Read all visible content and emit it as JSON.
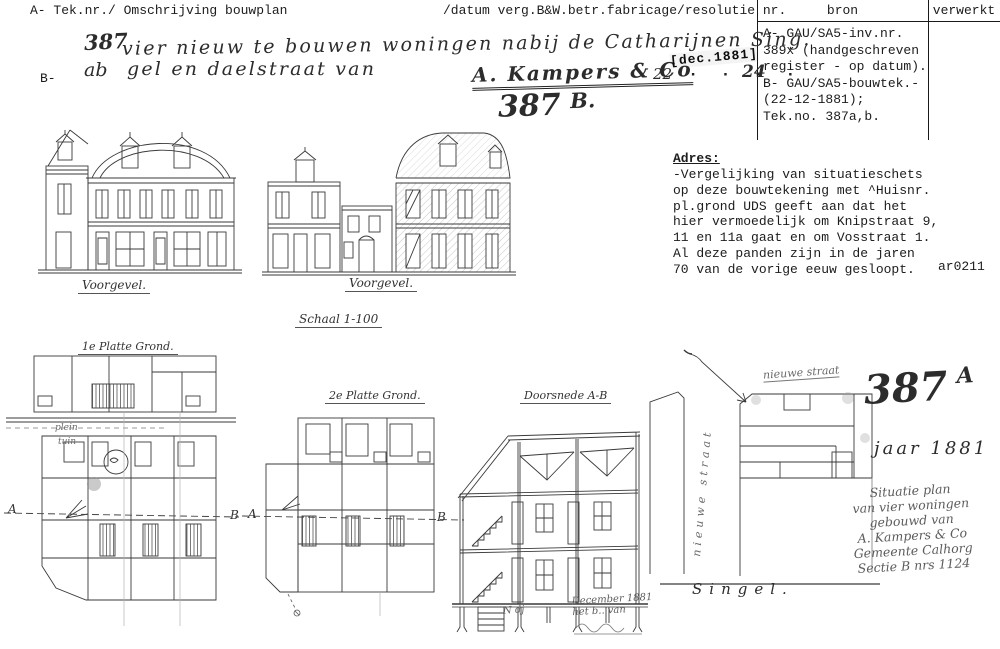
{
  "document": {
    "header_left": "A- Tek.nr./ Omschrijving bouwplan",
    "header_middle": "/datum verg.B&W.betr.fabricage/resolutie nr.",
    "b_label": "B-",
    "source_table": {
      "col_bron": "bron",
      "col_verwerkt": "verwerkt",
      "bron_text": "A- GAU/SA5-inv.nr.\n389x (handgeschreven\nregister - op datum).\nB- GAU/SA5-bouwtek.-\n(22-12-1881);\nTek.no. 387a,b."
    }
  },
  "handwriting": {
    "number": "387",
    "line1": "vier nieuw te bouwen woningen nabij de Catharijnen Sing.",
    "line2_prefix": "ab",
    "line2": "gel en daelstraat van",
    "signature": "A. Kampers & Co",
    "date_left": "22",
    "stamp": "[dec.1881]",
    "ink_dots": "· · · ·",
    "date_right": "24",
    "sheet_number": "387",
    "sheet_suffix": "B."
  },
  "adres": {
    "title": "Adres:",
    "body": "-Vergelijking van situatieschets\nop deze bouwtekening met ^Huisnr.\npl.grond UDS geeft aan dat het\nhier vermoedelijk om Knipstraat 9,\n11 en 11a gaat en om Vosstraat 1.\nAl deze panden zijn in de jaren\n70 van de vorige eeuw gesloopt.",
    "code": "ar0211"
  },
  "drawings": {
    "facade_left_label": "Voorgevel.",
    "facade_right_label": "Voorgevel.",
    "scale_label": "Schaal 1-100",
    "plan1_label": "1e Platte Grond.",
    "plan2_label": "2e Platte Grond.",
    "section_label": "Doorsnede A-B",
    "marker_a": "A",
    "marker_b": "B",
    "plan1_note_plein": "plein",
    "plan1_note_tuin": "tuin",
    "section_note": "December 1881\nhet b.. van",
    "section_mark": "N dj"
  },
  "site_plan": {
    "number": "387",
    "number_suffix": "A",
    "year": "jaar 1881",
    "new_street_label": "nieuwe straat",
    "street_vertical_label": "nieuwe straat",
    "singel_label": "Singel.",
    "note": "Situatie plan\nvan vier woningen\ngebouwd van\nA. Kampers & Co\nGemeente Calhorg\nSectie B nrs 1124"
  },
  "colors": {
    "paper": "#ffffff",
    "ink": "#1c1c1c",
    "pencil": "#5c5c5c",
    "line": "#3a3a3a"
  }
}
